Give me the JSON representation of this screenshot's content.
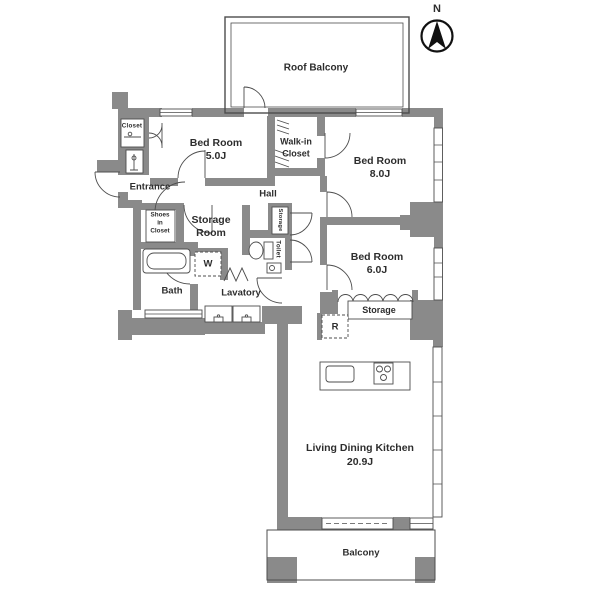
{
  "compass": {
    "north_label": "N"
  },
  "rooms": {
    "roof_balcony": {
      "label": "Roof Balcony"
    },
    "bedroom_5": {
      "label": "Bed Room",
      "size": "5.0J"
    },
    "closet": {
      "label": "Closet"
    },
    "walk_in_closet": {
      "label_line1": "Walk-in",
      "label_line2": "Closet"
    },
    "bedroom_8": {
      "label": "Bed Room",
      "size": "8.0J"
    },
    "entrance": {
      "label": "Entrance"
    },
    "hall": {
      "label": "Hall"
    },
    "shoes_in_closet": {
      "label_line1": "Shoes",
      "label_line2": "in",
      "label_line3": "Closet"
    },
    "storage_room": {
      "label_line1": "Storage",
      "label_line2": "Room"
    },
    "hall_storage": {
      "label": "Storage"
    },
    "toilet": {
      "label": "Toilet"
    },
    "bath": {
      "label": "Bath"
    },
    "lavatory": {
      "label": "Lavatory"
    },
    "washing_machine": {
      "label": "W"
    },
    "bedroom_6": {
      "label": "Bed Room",
      "size": "6.0J"
    },
    "storage": {
      "label": "Storage"
    },
    "refrigerator": {
      "label": "R"
    },
    "living_dining_kitchen": {
      "label": "Living Dining Kitchen",
      "size": "20.9J"
    },
    "balcony": {
      "label": "Balcony"
    }
  },
  "colors": {
    "wall": "#8a8a8a",
    "line": "#4d4d4d",
    "text": "#2d2d2d",
    "background": "#ffffff"
  }
}
